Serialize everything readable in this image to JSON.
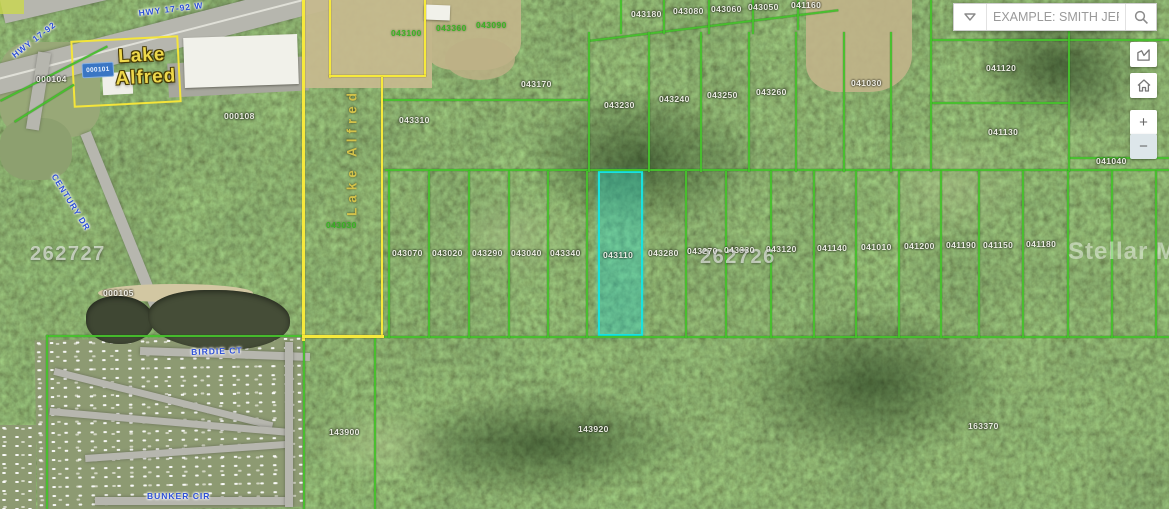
{
  "app": {
    "type": "gis-parcel-map-viewer"
  },
  "search": {
    "placeholder": "EXAMPLE: SMITH JER...",
    "value": "",
    "dropdown_icon": "caret-down",
    "submit_icon": "magnifier"
  },
  "controls": {
    "measure_icon": "measure-area",
    "home_icon": "home",
    "zoom_in_label": "+",
    "zoom_out_label": "−"
  },
  "watermark": "Stellar MLS",
  "sign": {
    "line1": "Lake",
    "line2": "Alfred"
  },
  "vertical_label": "Lake Alfred",
  "blue_tag": "000101",
  "selected_parcel": {
    "id": "043110"
  },
  "colors": {
    "parcel_line": "#46c02c",
    "boundary_line": "#f6e93c",
    "selected_parcel": "#19e2de",
    "parcel_label": "#f2f2ea",
    "green_label": "#35b31f",
    "road_label": "#2d50d6",
    "sign_text": "#eed84b"
  },
  "map": {
    "big_labels": [
      {
        "t": "262727",
        "x": 30,
        "y": 243
      },
      {
        "t": "262726",
        "x": 700,
        "y": 246
      }
    ],
    "road_labels": [
      {
        "t": "HWY 17-92 W",
        "x": 138,
        "y": 8,
        "rot": -7
      },
      {
        "t": "HWY 17-92",
        "x": 10,
        "y": 52,
        "rot": -38
      },
      {
        "t": "CENTURY DR",
        "x": 58,
        "y": 172,
        "rot": 58
      },
      {
        "t": "BIRDIE CT",
        "x": 191,
        "y": 347,
        "rot": -2
      },
      {
        "t": "BUNKER CIR",
        "x": 147,
        "y": 491,
        "rot": 0
      }
    ],
    "parcel_labels": [
      {
        "t": "043180",
        "x": 631,
        "y": 9
      },
      {
        "t": "043080",
        "x": 673,
        "y": 6
      },
      {
        "t": "043060",
        "x": 711,
        "y": 4
      },
      {
        "t": "043050",
        "x": 748,
        "y": 2
      },
      {
        "t": "041160",
        "x": 791,
        "y": 0
      },
      {
        "t": "043100",
        "x": 391,
        "y": 28,
        "c": "g"
      },
      {
        "t": "043360",
        "x": 436,
        "y": 23,
        "c": "g"
      },
      {
        "t": "043090",
        "x": 476,
        "y": 20,
        "c": "g"
      },
      {
        "t": "043030",
        "x": 326,
        "y": 220,
        "c": "g"
      },
      {
        "t": "043170",
        "x": 521,
        "y": 79
      },
      {
        "t": "043310",
        "x": 399,
        "y": 115
      },
      {
        "t": "043230",
        "x": 604,
        "y": 100
      },
      {
        "t": "043240",
        "x": 659,
        "y": 94
      },
      {
        "t": "043250",
        "x": 707,
        "y": 90
      },
      {
        "t": "043260",
        "x": 756,
        "y": 87
      },
      {
        "t": "041030",
        "x": 851,
        "y": 78
      },
      {
        "t": "041120",
        "x": 986,
        "y": 63
      },
      {
        "t": "041130",
        "x": 988,
        "y": 127
      },
      {
        "t": "041040",
        "x": 1096,
        "y": 156
      },
      {
        "t": "043070",
        "x": 392,
        "y": 248
      },
      {
        "t": "043020",
        "x": 432,
        "y": 248
      },
      {
        "t": "043290",
        "x": 472,
        "y": 248
      },
      {
        "t": "043040",
        "x": 511,
        "y": 248
      },
      {
        "t": "043340",
        "x": 550,
        "y": 248
      },
      {
        "t": "043110",
        "x": 603,
        "y": 250
      },
      {
        "t": "043280",
        "x": 648,
        "y": 248
      },
      {
        "t": "043270",
        "x": 687,
        "y": 246
      },
      {
        "t": "043330",
        "x": 724,
        "y": 245
      },
      {
        "t": "043120",
        "x": 766,
        "y": 244
      },
      {
        "t": "041140",
        "x": 817,
        "y": 243
      },
      {
        "t": "041010",
        "x": 861,
        "y": 242
      },
      {
        "t": "041200",
        "x": 904,
        "y": 241
      },
      {
        "t": "041190",
        "x": 946,
        "y": 240
      },
      {
        "t": "041150",
        "x": 983,
        "y": 240
      },
      {
        "t": "041180",
        "x": 1026,
        "y": 239
      },
      {
        "t": "143900",
        "x": 329,
        "y": 427
      },
      {
        "t": "143920",
        "x": 578,
        "y": 424
      },
      {
        "t": "163370",
        "x": 968,
        "y": 421
      },
      {
        "t": "000108",
        "x": 224,
        "y": 111
      },
      {
        "t": "000104",
        "x": 36,
        "y": 74
      },
      {
        "t": "000105",
        "x": 103,
        "y": 288
      }
    ],
    "lines": {
      "green": [
        {
          "x": 385,
          "y": 169,
          "w": 784,
          "h": 2
        },
        {
          "x": 303,
          "y": 336,
          "w": 866,
          "h": 2
        },
        {
          "x": 930,
          "y": 39,
          "w": 239,
          "h": 2
        },
        {
          "x": 930,
          "y": 102,
          "w": 139,
          "h": 2
        },
        {
          "x": 1068,
          "y": 157,
          "w": 101,
          "h": 2
        },
        {
          "x": 382,
          "y": 99,
          "w": 208,
          "h": 2
        },
        {
          "x": 588,
          "y": 40,
          "w": 252,
          "h": 2,
          "rot": -7
        },
        {
          "x": 0,
          "y": 100,
          "w": 120,
          "h": 2,
          "rot": -27
        },
        {
          "x": 14,
          "y": 121,
          "w": 70,
          "h": 2,
          "rot": -32
        },
        {
          "x": 46,
          "y": 335,
          "w": 258,
          "h": 2
        },
        {
          "x": 46,
          "y": 335,
          "w": 2,
          "h": 174
        },
        {
          "x": 303,
          "y": 338,
          "w": 2,
          "h": 171
        },
        {
          "x": 374,
          "y": 338,
          "w": 2,
          "h": 171
        },
        {
          "x": 930,
          "y": 0,
          "w": 2,
          "h": 172
        },
        {
          "x": 1068,
          "y": 6,
          "w": 2,
          "h": 166
        },
        {
          "x": 588,
          "y": 32,
          "w": 2,
          "h": 140
        },
        {
          "x": 648,
          "y": 32,
          "w": 2,
          "h": 140
        },
        {
          "x": 700,
          "y": 32,
          "w": 2,
          "h": 140
        },
        {
          "x": 748,
          "y": 32,
          "w": 2,
          "h": 140
        },
        {
          "x": 795,
          "y": 32,
          "w": 2,
          "h": 140
        },
        {
          "x": 843,
          "y": 32,
          "w": 2,
          "h": 140
        },
        {
          "x": 890,
          "y": 32,
          "w": 2,
          "h": 140
        },
        {
          "x": 620,
          "y": 0,
          "w": 2,
          "h": 34
        },
        {
          "x": 663,
          "y": 0,
          "w": 2,
          "h": 34
        },
        {
          "x": 708,
          "y": 0,
          "w": 2,
          "h": 34
        },
        {
          "x": 752,
          "y": 0,
          "w": 2,
          "h": 34
        },
        {
          "x": 797,
          "y": 0,
          "w": 2,
          "h": 30
        },
        {
          "x": 388,
          "y": 171,
          "w": 2,
          "h": 167
        },
        {
          "x": 428,
          "y": 171,
          "w": 2,
          "h": 167
        },
        {
          "x": 468,
          "y": 171,
          "w": 2,
          "h": 167
        },
        {
          "x": 508,
          "y": 171,
          "w": 2,
          "h": 167
        },
        {
          "x": 547,
          "y": 171,
          "w": 2,
          "h": 167
        },
        {
          "x": 586,
          "y": 171,
          "w": 2,
          "h": 167
        },
        {
          "x": 685,
          "y": 171,
          "w": 2,
          "h": 167
        },
        {
          "x": 725,
          "y": 171,
          "w": 2,
          "h": 167
        },
        {
          "x": 770,
          "y": 171,
          "w": 2,
          "h": 167
        },
        {
          "x": 813,
          "y": 171,
          "w": 2,
          "h": 167
        },
        {
          "x": 855,
          "y": 171,
          "w": 2,
          "h": 167
        },
        {
          "x": 898,
          "y": 171,
          "w": 2,
          "h": 167
        },
        {
          "x": 940,
          "y": 171,
          "w": 2,
          "h": 167
        },
        {
          "x": 978,
          "y": 171,
          "w": 2,
          "h": 167
        },
        {
          "x": 1022,
          "y": 171,
          "w": 2,
          "h": 167
        },
        {
          "x": 1067,
          "y": 171,
          "w": 2,
          "h": 167
        },
        {
          "x": 1111,
          "y": 171,
          "w": 2,
          "h": 167
        },
        {
          "x": 1155,
          "y": 171,
          "w": 2,
          "h": 167
        }
      ],
      "yellow": [
        {
          "x": 302,
          "y": 0,
          "w": 3,
          "h": 341
        },
        {
          "x": 329,
          "y": 0,
          "w": 2,
          "h": 78
        },
        {
          "x": 424,
          "y": 0,
          "w": 2,
          "h": 76
        },
        {
          "x": 329,
          "y": 75,
          "w": 97,
          "h": 2
        },
        {
          "x": 381,
          "y": 77,
          "w": 2,
          "h": 260
        },
        {
          "x": 302,
          "y": 335,
          "w": 82,
          "h": 3
        }
      ]
    }
  }
}
